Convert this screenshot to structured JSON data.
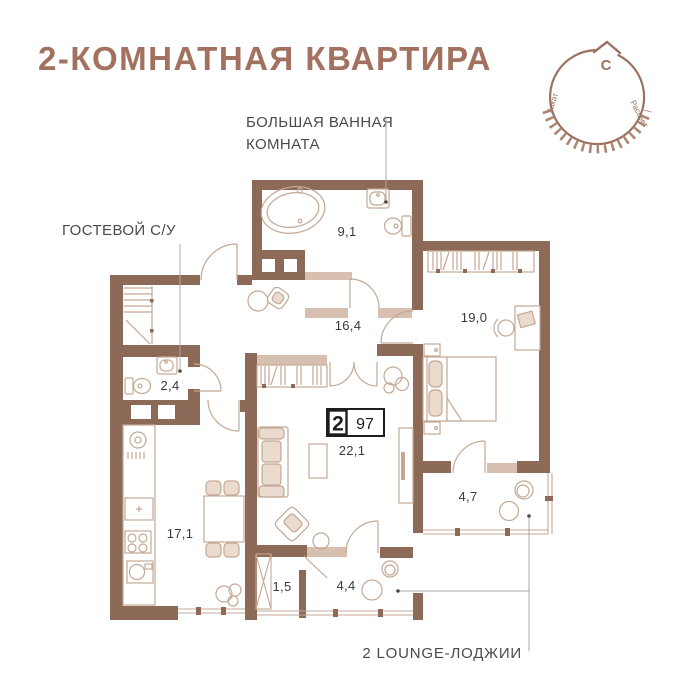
{
  "title": "2-КОМНАТНАЯ КВАРТИРА",
  "labels": {
    "big_bathroom_line1": "БОЛЬШАЯ ВАННАЯ",
    "big_bathroom_line2": "КОМНАТА",
    "guest_wc": "ГОСТЕВОЙ С/У",
    "lounge": "2 LOUNGE-ЛОДЖИИ"
  },
  "compass": {
    "north": "С",
    "sunset": "Закат",
    "sunrise": "Рассвет"
  },
  "badge": {
    "rooms": "2",
    "area": "97"
  },
  "rooms": [
    {
      "name": "big-bathroom",
      "area": "9,1"
    },
    {
      "name": "hallway",
      "area": "16,4"
    },
    {
      "name": "bedroom",
      "area": "19,0"
    },
    {
      "name": "guest-wc",
      "area": "2,4"
    },
    {
      "name": "living-room",
      "area": "22,1"
    },
    {
      "name": "kitchen",
      "area": "17,1"
    },
    {
      "name": "loggia-right",
      "area": "4,7"
    },
    {
      "name": "loggia-small",
      "area": "1,5"
    },
    {
      "name": "loggia-lounge",
      "area": "4,4"
    }
  ],
  "colors": {
    "wall": "#8C6A57",
    "sill": "#D7C0AF",
    "furniture_stroke": "#C4A894",
    "accent_title": "#A2715F",
    "label_text": "#4A4A48",
    "leader": "#A8A8A6"
  }
}
